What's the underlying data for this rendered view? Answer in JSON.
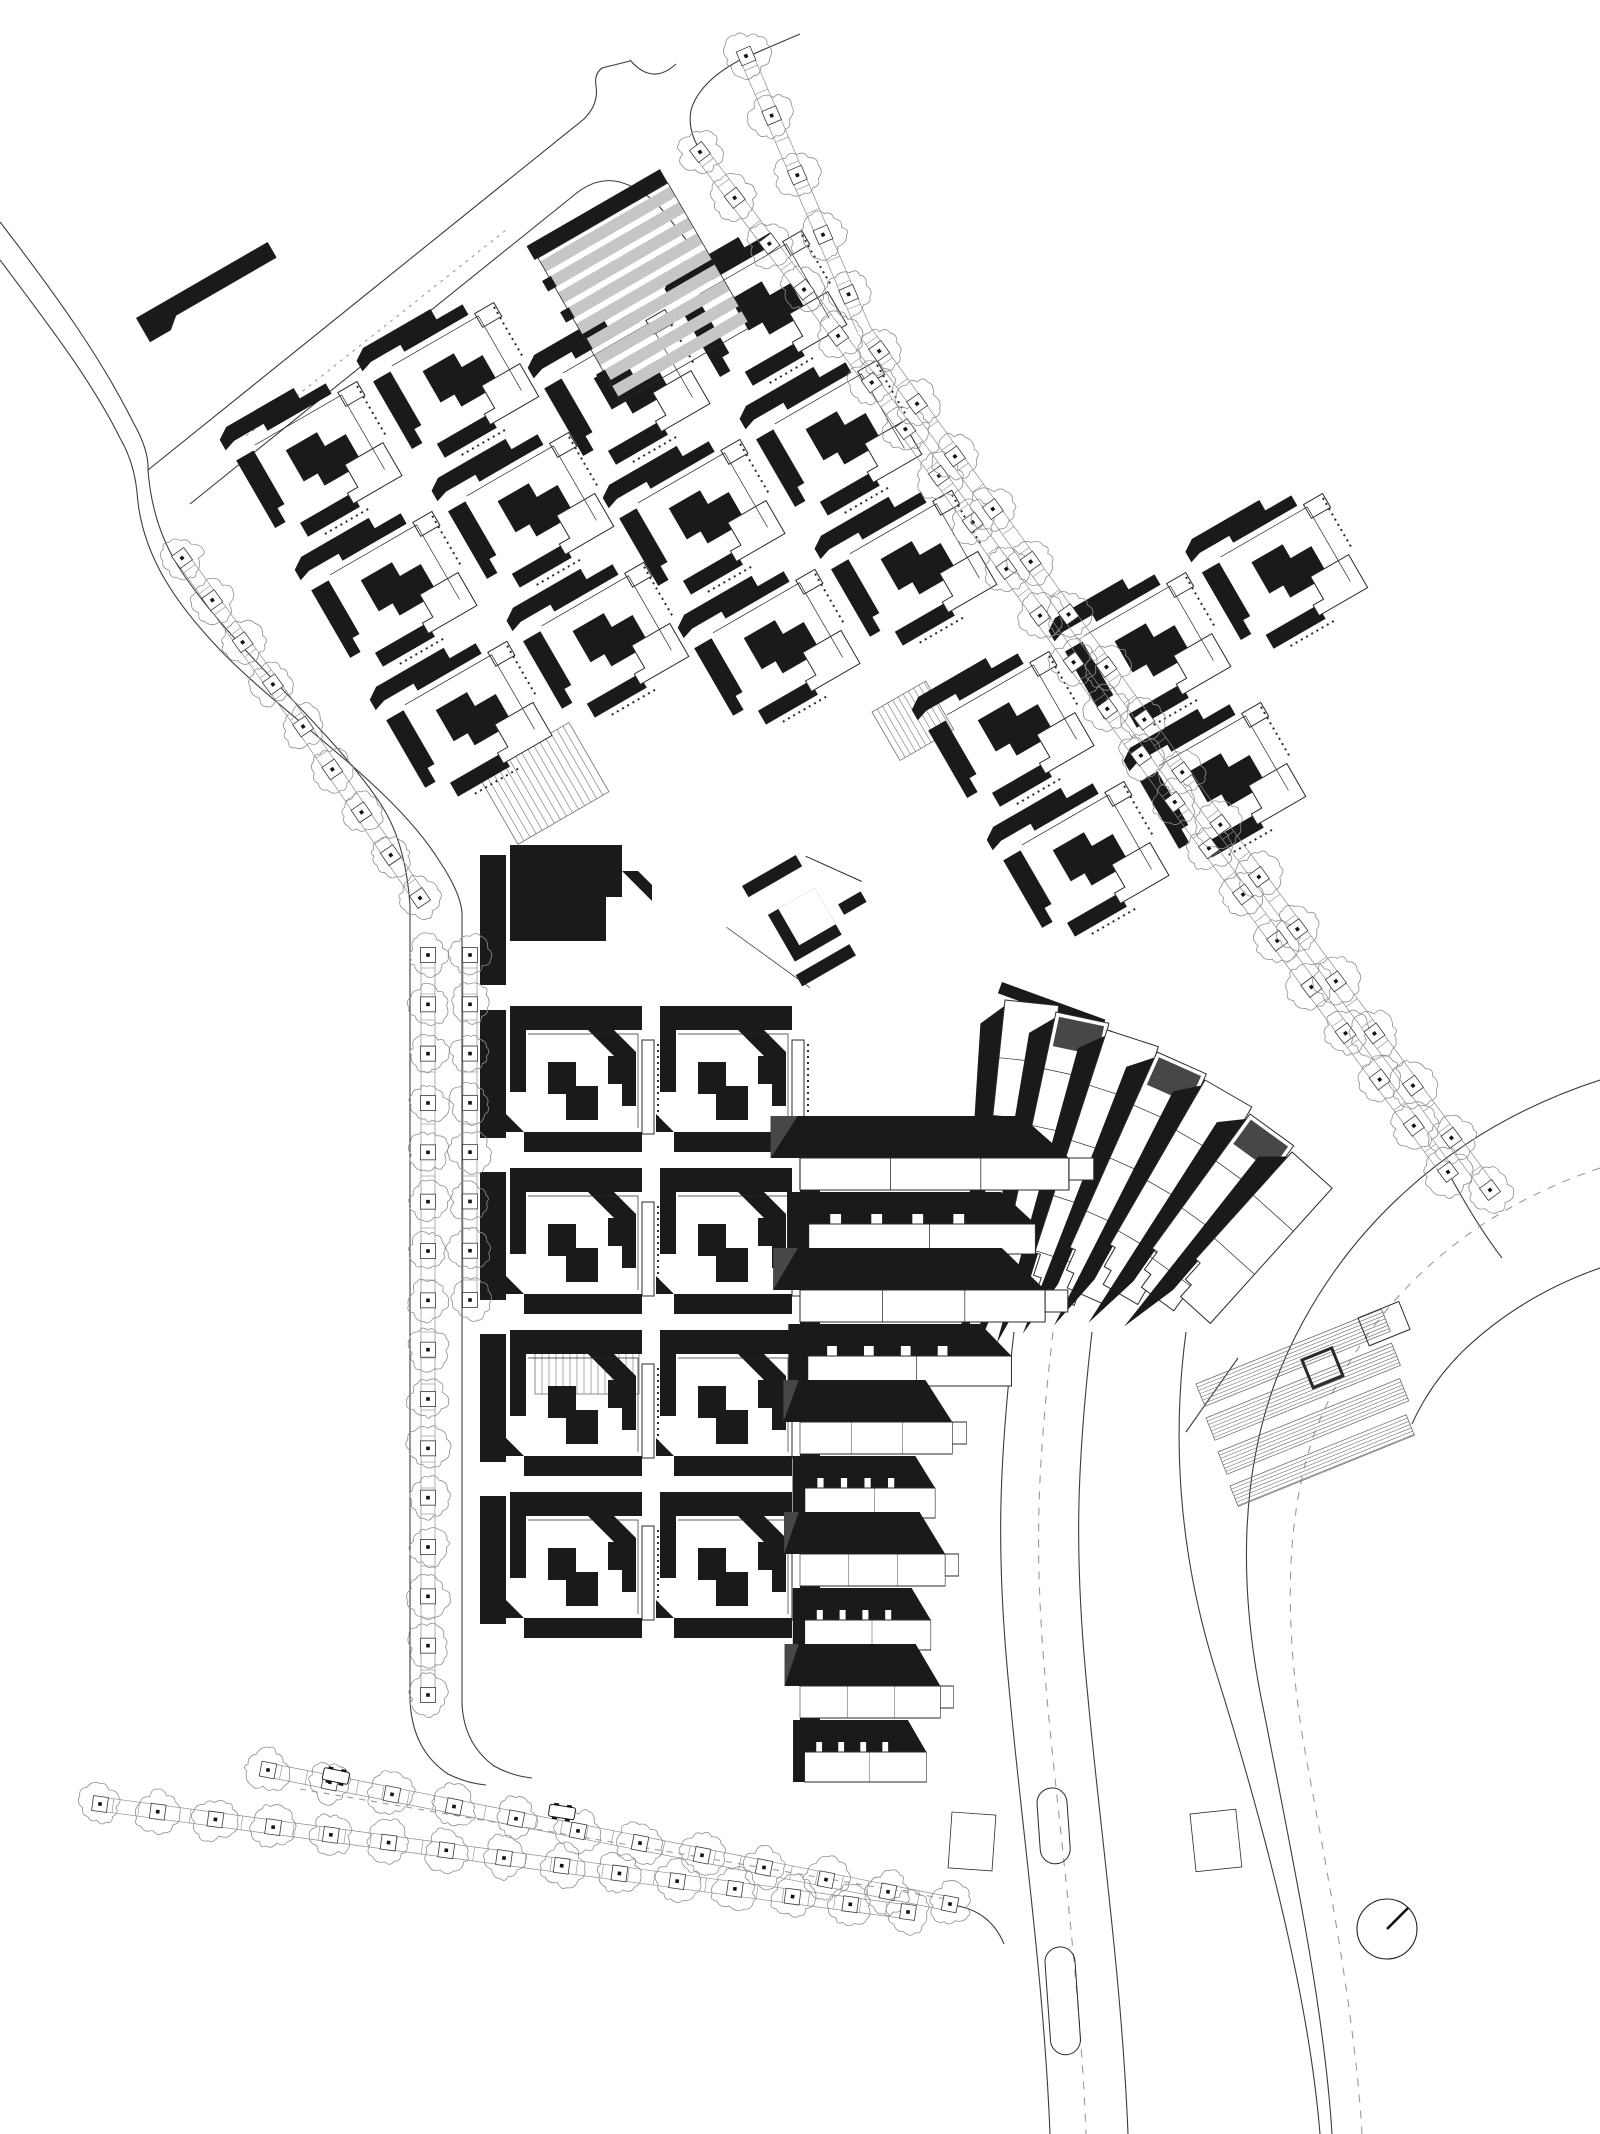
{
  "drawing": {
    "kind": "architectural-site-plan",
    "canvas": {
      "width": 1600,
      "height": 2134,
      "background": "#ffffff"
    },
    "palette": {
      "building_black": "#1a1a1a",
      "white": "#ffffff",
      "hall_gray": "#c6c6c6",
      "accent_darkgray": "#474747",
      "road_line": "#3c3c3c",
      "thin_line": "#2b2b2b",
      "tree_line": "#8f8f8f",
      "ladder_line": "#8d8d8d",
      "hatch_line": "#6f6f6f",
      "dash_line": "#9a9a9a"
    },
    "motifs": {
      "pblock": [
        {
          "d": "M2,8 L14,0 H92 V12 H122 V24 H48 V16 H14 L2,20 Z",
          "f": "k"
        },
        {
          "d": "M6,34 H26 V96 H18 V112 H6 Z",
          "f": "k"
        },
        {
          "d": "M54,50 H90 V66 H114 V100 H70 V86 H54 Z",
          "f": "k"
        },
        {
          "d": "M30,120 H90 V136 H30 Z",
          "f": "k"
        },
        {
          "d": "M128,26 h22 v16 h-22 z",
          "f": "w",
          "s": 1
        },
        {
          "d": "M98,92 h44 v38 h-56 v-12 h12 z",
          "f": "w",
          "s": 1
        },
        {
          "d": "M30,30 H130 V116",
          "f": "n",
          "s": 1,
          "w": 0.7
        },
        {
          "d": "M148,30 V88",
          "f": "n",
          "s": 1,
          "w": 2,
          "dash": "2,4"
        },
        {
          "d": "M46,142 H100",
          "f": "n",
          "s": 1,
          "w": 2,
          "dash": "2,4"
        }
      ],
      "cblock": [
        {
          "d": "M0,0 H132 V24 H0 Z",
          "f": "k"
        },
        {
          "d": "M78,24 L126,72 V46 L104,24 Z",
          "f": "k"
        },
        {
          "d": "M0,24 H16 V86 H0 Z",
          "f": "k"
        },
        {
          "d": "M38,56 H66 V80 H88 V114 H56 V88 H38 Z",
          "f": "k"
        },
        {
          "d": "M98,50 H126 V100 H112 V78 H98 Z",
          "f": "k"
        },
        {
          "d": "M14,126 H132 V146 H14 Z",
          "f": "k"
        },
        {
          "d": "M14,126 L-4,108 V126 Z",
          "f": "k"
        },
        {
          "d": "M132,34 h12 v94 h-12 z",
          "f": "w",
          "s": 1
        },
        {
          "d": "M148,38 V124",
          "f": "n",
          "s": 1,
          "w": 2,
          "dash": "2,4"
        },
        {
          "d": "M18,28 H128 V122",
          "f": "n",
          "s": 1,
          "w": 0.7
        }
      ],
      "hall": [
        {
          "d": "M-4,-16 H150 V0 H-4 Z",
          "f": "k"
        },
        {
          "d": "M0,4 h150 v12 h-150 z",
          "f": "g"
        },
        {
          "d": "M0,22 h150 v12 h-150 z",
          "f": "g"
        },
        {
          "d": "M0,40 h150 v12 h-150 z",
          "f": "g"
        },
        {
          "d": "M0,58 h150 v12 h-150 z",
          "f": "g"
        },
        {
          "d": "M0,76 h150 v12 h-150 z",
          "f": "g"
        },
        {
          "d": "M0,94 h150 v12 h-150 z",
          "f": "g"
        },
        {
          "d": "M0,112 h150 v12 h-150 z",
          "f": "g"
        },
        {
          "d": "M0,130 h150 v12 h-150 z",
          "f": "g"
        },
        {
          "d": "M0,148 h150 v12 h-150 z",
          "f": "g"
        },
        {
          "d": "M0,0 H150 V166 H0 Z",
          "f": "n",
          "s": 1,
          "w": 0.8
        },
        {
          "d": "M-8,22 h10 v12 h-10 z M-8,58 h10 v12 h-10 z M-8,94 h10 v12 h-10 z M-8,130 h10 v12 h-10 z",
          "f": "k"
        }
      ],
      "abar": [
        {
          "d": "M0,0 H152 V18 H36 L24,28 H0 Z",
          "f": "k"
        }
      ],
      "dmass": [
        {
          "d": "M0,0 H112 V52 H96 V96 H0 Z",
          "f": "k"
        },
        {
          "d": "M112,26 l30,30 v-16 l-14,-14 z",
          "f": "k"
        }
      ],
      "plaza": [
        {
          "d": "M0,0 h62 v13 h-62 z",
          "f": "k"
        },
        {
          "d": "M70,6 L106,56",
          "f": "n",
          "s": 1,
          "w": 1
        },
        {
          "d": "M8,38 h54 v54 h-54 z",
          "f": "k"
        },
        {
          "d": "M20,38 h42 v42 h-42 z",
          "f": "w"
        },
        {
          "d": "M74,64 h26 v12 h-26 z",
          "f": "k"
        },
        {
          "d": "M2,104 h62 v13 h-62 z",
          "f": "k"
        },
        {
          "d": "M-34,28 L8,122",
          "f": "n",
          "s": 1,
          "w": 0.7
        }
      ]
    },
    "instances": [
      {
        "name": "cluster-northwest",
        "motif": "pblock",
        "x": 214,
        "y": 434,
        "rot": -30,
        "dx": 158,
        "dy": 150,
        "cells": [
          [
            0,
            0
          ],
          [
            1,
            0
          ],
          [
            0,
            1
          ],
          [
            1,
            1
          ],
          [
            0,
            2
          ],
          [
            1,
            2
          ]
        ]
      },
      {
        "name": "cluster-north",
        "motif": "pblock",
        "x": 522,
        "y": 362,
        "rot": -30,
        "dx": 158,
        "dy": 150,
        "cells": [
          [
            0,
            0
          ],
          [
            1,
            0
          ],
          [
            0,
            1
          ],
          [
            1,
            1
          ],
          [
            0,
            2
          ],
          [
            1,
            2
          ]
        ]
      },
      {
        "name": "cluster-northeast",
        "motif": "pblock",
        "x": 906,
        "y": 704,
        "rot": -30,
        "dx": 158,
        "dy": 150,
        "cells": [
          [
            0,
            0
          ],
          [
            1,
            0
          ],
          [
            2,
            0
          ],
          [
            0,
            1
          ],
          [
            1,
            1
          ]
        ]
      },
      {
        "name": "cluster-middle",
        "motif": "cblock",
        "x": 510,
        "y": 1006,
        "rot": 0,
        "dx": 150,
        "dy": 162,
        "cells": [
          [
            0,
            0
          ],
          [
            1,
            0
          ],
          [
            0,
            1
          ],
          [
            1,
            1
          ],
          [
            0,
            2
          ],
          [
            1,
            2
          ],
          [
            0,
            3
          ],
          [
            1,
            3
          ]
        ]
      },
      {
        "name": "gray-hall",
        "motif": "hall",
        "x": 538,
        "y": 258,
        "rot": -30,
        "dx": 0,
        "dy": 0,
        "cells": [
          [
            0,
            0
          ]
        ]
      },
      {
        "name": "lone-bar",
        "motif": "abar",
        "x": 136,
        "y": 318,
        "rot": -30,
        "dx": 0,
        "dy": 0,
        "cells": [
          [
            0,
            0
          ]
        ]
      },
      {
        "name": "middle-top-mass",
        "motif": "dmass",
        "x": 510,
        "y": 845,
        "rot": 0,
        "dx": 0,
        "dy": 0,
        "cells": [
          [
            0,
            0
          ]
        ]
      },
      {
        "name": "plaza-pavilion",
        "motif": "plaza",
        "x": 742,
        "y": 886,
        "rot": -30,
        "dx": 0,
        "dy": 0,
        "cells": [
          [
            0,
            0
          ]
        ]
      }
    ],
    "bars": [
      {
        "x": 480,
        "y": 855,
        "w": 26,
        "h": 130,
        "rot": 0
      },
      {
        "x": 480,
        "y": 1010,
        "w": 26,
        "h": 128,
        "rot": 0
      },
      {
        "x": 480,
        "y": 1172,
        "w": 26,
        "h": 128,
        "rot": 0
      },
      {
        "x": 480,
        "y": 1334,
        "w": 26,
        "h": 128,
        "rot": 0
      },
      {
        "x": 480,
        "y": 1496,
        "w": 26,
        "h": 128,
        "rot": 0
      },
      {
        "x": 800,
        "y": 1145,
        "w": 20,
        "h": 628,
        "rot": 0
      },
      {
        "x": 1002,
        "y": 982,
        "w": 110,
        "h": 12,
        "rot": 20
      },
      {
        "x": 1110,
        "y": 1030,
        "w": 110,
        "h": 12,
        "rot": 28
      }
    ],
    "fan": {
      "w": 54,
      "strips": [
        {
          "x": 1005,
          "y": 1000,
          "rot": 6,
          "len": 300,
          "gray": 0
        },
        {
          "x": 1056,
          "y": 1012,
          "rot": 12,
          "len": 290,
          "gray": 1
        },
        {
          "x": 1107,
          "y": 1030,
          "rot": 18,
          "len": 272,
          "gray": 0
        },
        {
          "x": 1157,
          "y": 1052,
          "rot": 24,
          "len": 252,
          "gray": 1
        },
        {
          "x": 1205,
          "y": 1080,
          "rot": 30,
          "len": 228,
          "gray": 0
        },
        {
          "x": 1250,
          "y": 1114,
          "rot": 36,
          "len": 204,
          "gray": 1
        },
        {
          "x": 1292,
          "y": 1152,
          "rot": 42,
          "len": 182,
          "gray": 0
        }
      ]
    },
    "erows": {
      "x": 800,
      "items": [
        {
          "y": 1150,
          "type": "A",
          "sx": 1.13
        },
        {
          "y": 1216,
          "type": "B",
          "sx": 1.08
        },
        {
          "y": 1282,
          "type": "A",
          "sx": 1.03
        },
        {
          "y": 1348,
          "type": "B",
          "sx": 0.97
        },
        {
          "y": 1414,
          "type": "A",
          "sx": 0.64
        },
        {
          "y": 1480,
          "type": "B",
          "sx": 0.62
        },
        {
          "y": 1546,
          "type": "A",
          "sx": 0.61
        },
        {
          "y": 1612,
          "type": "B",
          "sx": 0.6
        },
        {
          "y": 1678,
          "type": "A",
          "sx": 0.59
        },
        {
          "y": 1744,
          "type": "B",
          "sx": 0.58
        }
      ]
    },
    "roads": [
      {
        "d": "M148,470 L584,119 Q599,104 596,86 Q594,74 602,68 L630,61"
      },
      {
        "d": "M630,60 Q652,86 676,64"
      },
      {
        "d": "M800,34 L744,58 Q700,80 691,110 Q687,132 702,153"
      },
      {
        "d": "M190,504 L573,196 Q596,176 620,182 Q646,190 664,212 L688,242"
      },
      {
        "d": "M0,222 C60,300 102,360 133,422 Q149,450 148,470"
      },
      {
        "d": "M0,260 C54,332 92,382 120,438 Q134,462 137,492"
      },
      {
        "d": "M148,470 Q152,524 178,566 C230,648 330,726 382,806 Q406,844 410,906 L410,1700 Q412,1750 448,1774 Q466,1783 486,1785"
      },
      {
        "d": "M137,492 C141,556 178,608 230,660 C298,726 396,790 440,862 Q460,892 462,912 L462,1704 Q464,1744 494,1766 Q512,1776 532,1778"
      },
      {
        "d": "M1014,1332 C998,1470 996,1560 1010,1698 C1022,1828 1044,1982 1050,2134"
      },
      {
        "d": "M1092,1332 C1076,1470 1074,1560 1088,1698 C1100,1828 1122,1982 1128,2134"
      },
      {
        "d": "M1186,1332 C1172,1436 1178,1552 1216,1672 C1258,1806 1308,1986 1320,2134"
      },
      {
        "d": "M1600,1080 C1452,1128 1334,1232 1276,1380 C1240,1476 1238,1590 1264,1712 C1292,1856 1324,2006 1332,2134"
      },
      {
        "d": "M1600,1268 Q1520,1296 1462,1352 Q1430,1384 1412,1424"
      },
      {
        "d": "M1448,1172 Q1476,1224 1502,1258"
      },
      {
        "d": "M1186,1432 L1238,1358"
      },
      {
        "d": "M952,1905 Q990,1910 1004,1944"
      },
      {
        "d": "M246,436 L506,230",
        "dash": "3,5"
      },
      {
        "d": "M300,1789 L952,1900",
        "dash": "6,6"
      },
      {
        "d": "M1600,1168 C1470,1212 1372,1296 1318,1424 C1284,1512 1282,1630 1308,1768 C1332,1896 1356,2028 1362,2134",
        "dash": "8,8"
      },
      {
        "d": "M1053,1332 C1036,1478 1034,1560 1047,1698 C1059,1828 1080,1982 1086,2134",
        "dash": "8,8"
      }
    ],
    "hatches": [
      {
        "x": 478,
        "y": 775,
        "rot": -30,
        "w": 105,
        "h": 80,
        "gap": 7,
        "dir": "v"
      },
      {
        "x": 872,
        "y": 712,
        "rot": -30,
        "w": 62,
        "h": 56,
        "gap": 6,
        "dir": "v"
      },
      {
        "x": 535,
        "y": 1336,
        "rot": 0,
        "w": 104,
        "h": 58,
        "gap": 7,
        "dir": "v"
      },
      {
        "x": 1196,
        "y": 1384,
        "rot": -22,
        "w": 200,
        "h": 24,
        "gap": 3.5,
        "dir": "h"
      },
      {
        "x": 1206,
        "y": 1418,
        "rot": -22,
        "w": 200,
        "h": 24,
        "gap": 3.5,
        "dir": "h"
      },
      {
        "x": 1218,
        "y": 1452,
        "rot": -22,
        "w": 196,
        "h": 24,
        "gap": 3.5,
        "dir": "h"
      },
      {
        "x": 1230,
        "y": 1486,
        "rot": -22,
        "w": 190,
        "h": 22,
        "gap": 3.5,
        "dir": "h"
      }
    ],
    "outline_rects": [
      {
        "x": 1302,
        "y": 1360,
        "w": 32,
        "h": 30,
        "rot": -22,
        "th": 3
      },
      {
        "x": 1358,
        "y": 1318,
        "w": 44,
        "h": 30,
        "rot": -22,
        "th": 1
      },
      {
        "x": 1036,
        "y": 1789,
        "w": 30,
        "h": 76,
        "rot": -4,
        "rx": 15,
        "th": 1
      },
      {
        "x": 1044,
        "y": 1948,
        "w": 30,
        "h": 108,
        "rot": -4,
        "rx": 15,
        "th": 1
      },
      {
        "x": 952,
        "y": 1812,
        "w": 44,
        "h": 56,
        "rot": 4,
        "th": 0.8
      },
      {
        "x": 1190,
        "y": 1814,
        "w": 46,
        "h": 58,
        "rot": -6,
        "th": 0.8
      }
    ],
    "tree_rows": [
      {
        "name": "west-road-row",
        "r": 20,
        "n": 9,
        "pts": [
          [
            182,
            558
          ],
          [
            300,
            722
          ],
          [
            420,
            898
          ]
        ]
      },
      {
        "name": "mid-avenue-west-row",
        "r": 19,
        "n": 16,
        "pts": [
          [
            428,
            955
          ],
          [
            428,
            1695
          ]
        ]
      },
      {
        "name": "mid-avenue-east-row",
        "r": 19,
        "n": 8,
        "pts": [
          [
            470,
            955
          ],
          [
            470,
            1300
          ]
        ]
      },
      {
        "name": "south-avenue-upper-row",
        "r": 20,
        "n": 12,
        "pts": [
          [
            268,
            1770
          ],
          [
            950,
            1904
          ]
        ]
      },
      {
        "name": "south-avenue-lower-row",
        "r": 20,
        "n": 15,
        "pts": [
          [
            100,
            1804
          ],
          [
            908,
            1912
          ]
        ]
      },
      {
        "name": "northeast-avenue-inner-row",
        "r": 21,
        "n": 23,
        "pts": [
          [
            700,
            152
          ],
          [
            818,
            308
          ],
          [
            1160,
            782
          ],
          [
            1448,
            1172
          ]
        ]
      },
      {
        "name": "northeast-avenue-outer-row",
        "r": 21,
        "n": 22,
        "pts": [
          [
            746,
            56
          ],
          [
            864,
            330
          ],
          [
            1205,
            804
          ],
          [
            1490,
            1190
          ]
        ]
      }
    ],
    "cars": [
      {
        "x": 336,
        "y": 1776,
        "rot": 12
      },
      {
        "x": 562,
        "y": 1812,
        "rot": 9
      }
    ],
    "compass": {
      "cx": 1387,
      "cy": 1929,
      "r": 30,
      "hand_dx": 21,
      "hand_dy": -21
    }
  }
}
